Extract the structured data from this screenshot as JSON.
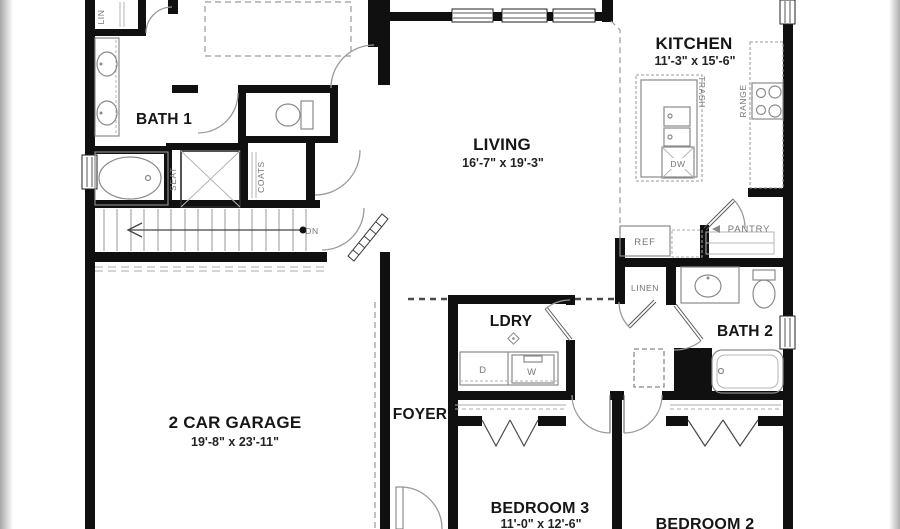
{
  "page": {
    "background": "#ffffff",
    "edge_shadow_color": "#a8a8a8",
    "wall_color": "#101010",
    "fixture_color": "#8a8a8a"
  },
  "plan": {
    "rooms": {
      "bath1": {
        "label": "BATH 1"
      },
      "living": {
        "label": "LIVING",
        "dims": "16'-7\" x 19'-3\""
      },
      "kitchen": {
        "label": "KITCHEN",
        "dims": "11'-3\" x 15'-6\""
      },
      "pantry": {
        "label": "PANTRY"
      },
      "garage": {
        "label": "2 CAR GARAGE",
        "dims": "19'-8\" x 23'-11\""
      },
      "foyer": {
        "label": "FOYER"
      },
      "laundry": {
        "label": "LDRY"
      },
      "bath2": {
        "label": "BATH 2"
      },
      "bedroom3": {
        "label": "BEDROOM 3",
        "dims": "11'-0\" x 12'-6\""
      },
      "bedroom2": {
        "label": "BEDROOM 2"
      }
    },
    "fixtures": {
      "linen_small": "LIN",
      "coats": "COATS",
      "seat": "SEAT",
      "trash": "TRASH",
      "range": "RANGE",
      "dishwasher": "DW",
      "refrigerator": "REF",
      "linen_hall": "LINEN",
      "dryer": "D",
      "washer": "W",
      "stairs_down": "DN"
    }
  }
}
